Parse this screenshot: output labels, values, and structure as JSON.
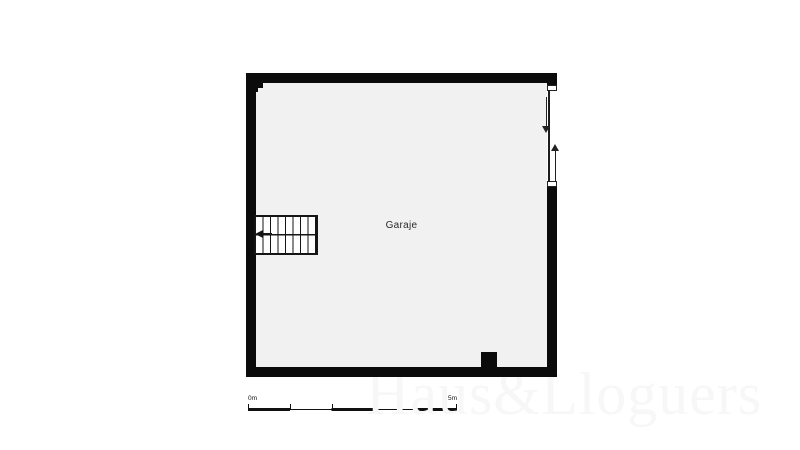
{
  "floorplan": {
    "room_label": "Garaje",
    "wall_color": "#0b0b0b",
    "floor_color": "#f1f1f1",
    "stairs": {
      "steps": 8,
      "direction": "left"
    },
    "door": {
      "type": "sliding",
      "arrow_directions": [
        "down",
        "up"
      ]
    }
  },
  "scale_bar": {
    "start_label": "0m",
    "end_label": "5m",
    "segments": 5
  },
  "watermark": {
    "text": "Haus&Lloguers",
    "color": "#f7f7f7"
  }
}
